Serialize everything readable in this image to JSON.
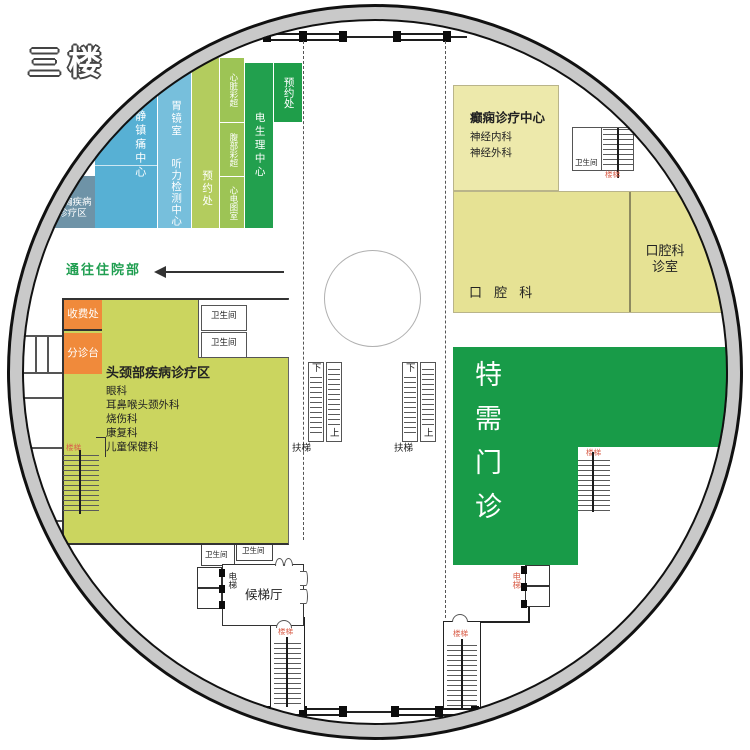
{
  "floor_title": "三楼",
  "colors": {
    "ring_gray": "#c9c9c9",
    "blue_slate": "#6E93A7",
    "blue": "#57B0D4",
    "blue_light": "#77BFDC",
    "green_light": "#B3CC5E",
    "green_mid": "#9DC455",
    "green_dark": "#21A04E",
    "green_vip": "#189B48",
    "yellow_pale": "#EDE9AB",
    "yellow": "#E6E294",
    "yellow_green": "#CBD55F",
    "orange": "#F08A3B",
    "label_red": "#D95F4A",
    "text_green": "#1F9E50"
  },
  "labels": {
    "restroom": "卫生间",
    "stairs": "楼梯",
    "elevator": "电梯",
    "escalator": "扶梯",
    "up": "上",
    "down": "下",
    "appointment": "预约处",
    "lobby": "候梯厅",
    "to_inpatient": "通往住院部"
  },
  "rooms": {
    "cardiothoracic_l1": "心胸疾病",
    "cardiothoracic_l2": "诊疗区",
    "sedation": "镇静镇痛中心",
    "gastroscopy": "胃镜室",
    "hearing_test": "听力检测中心",
    "cardiac_ultrasound": "心脏彩超",
    "abdominal_ultrasound": "腹部彩超",
    "ecg_room": "心电图室",
    "electrophysiology": "电生理中心",
    "epilepsy": {
      "title": "癫痫诊疗中心",
      "items": [
        "神经内科",
        "神经外科"
      ]
    },
    "dental": "口 腔 科",
    "dental_room_l1": "口腔科",
    "dental_room_l2": "诊室",
    "vip_clinic": "特需门诊",
    "cashier": "收费处",
    "triage": "分诊台",
    "head_neck": {
      "title": "头颈部疾病诊疗区",
      "items": [
        "眼科",
        "耳鼻喉头颈外科",
        "烧伤科",
        "康复科",
        "儿童保健科"
      ]
    }
  }
}
